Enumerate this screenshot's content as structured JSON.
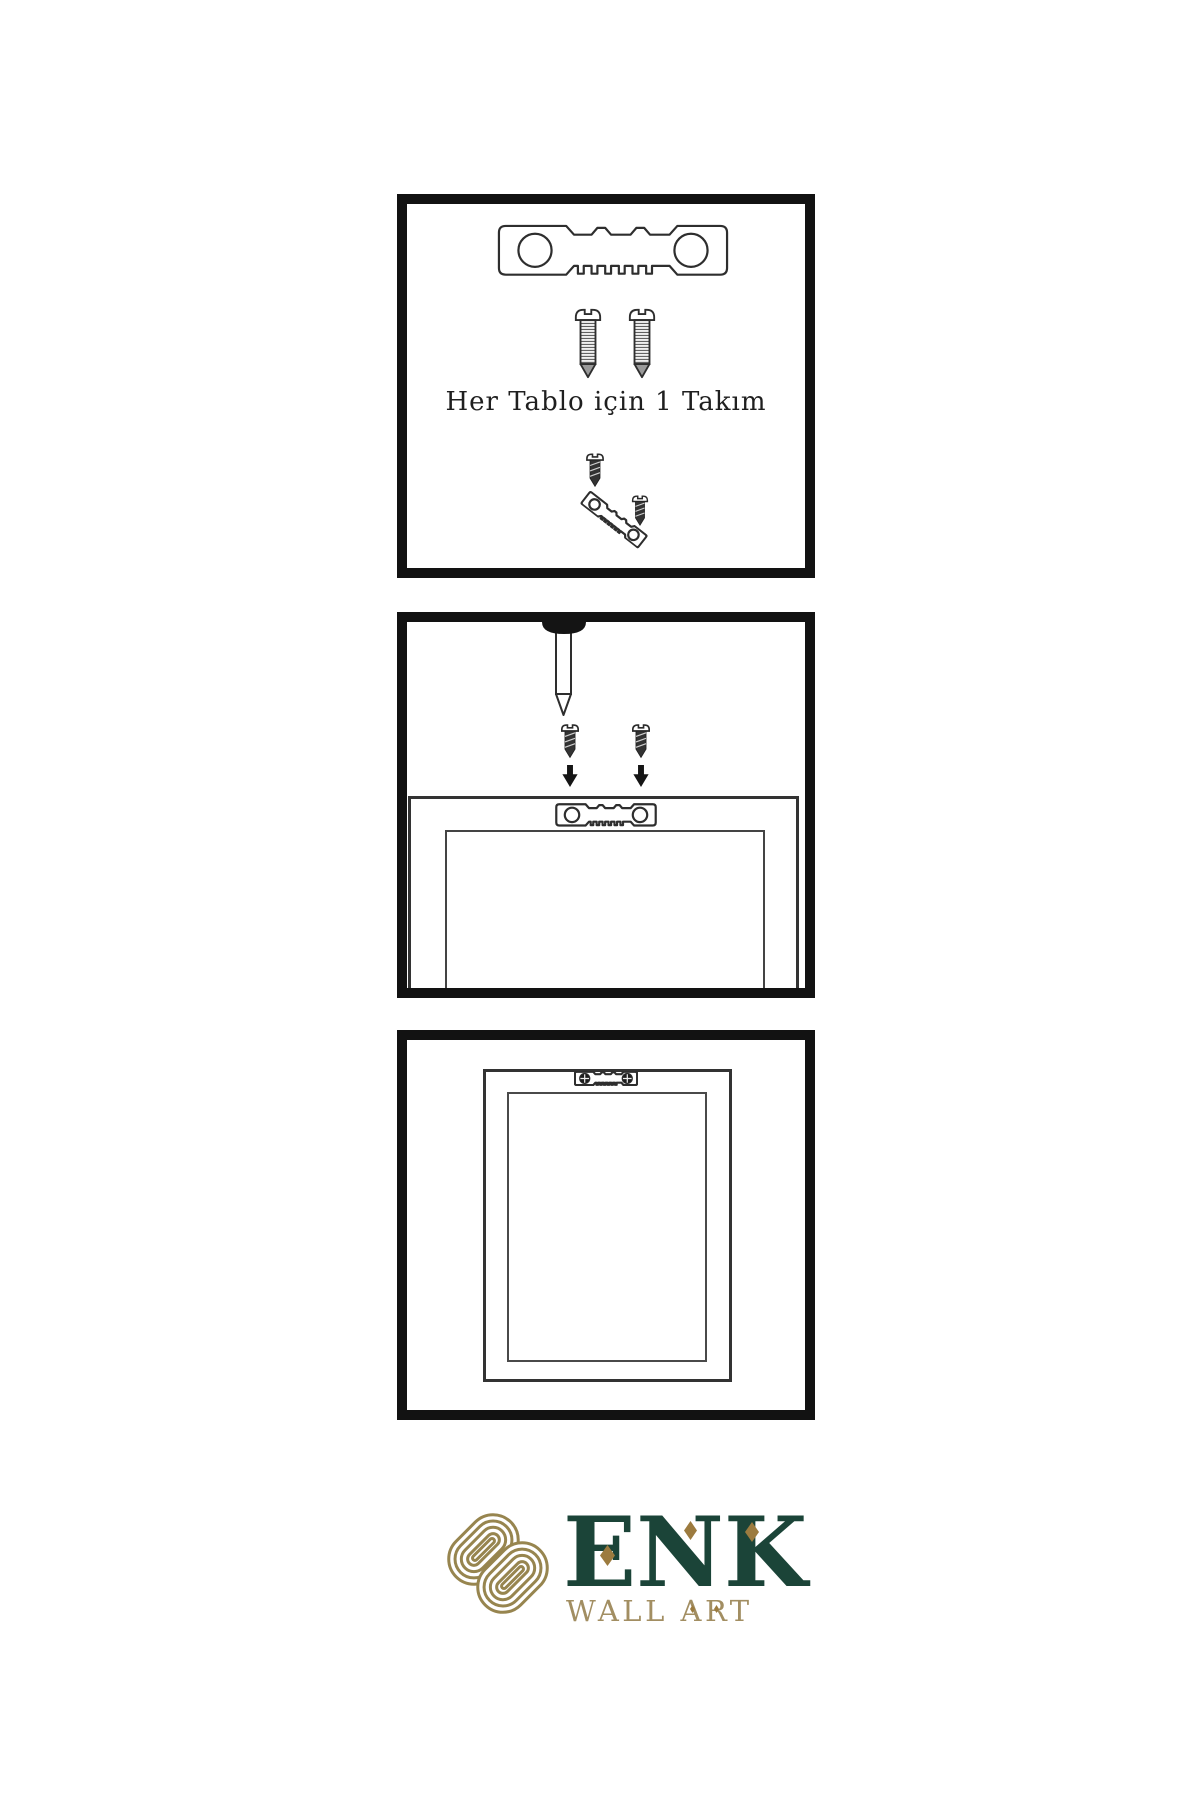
{
  "step1": {
    "caption": "Her Tablo için 1 Takım"
  },
  "logo": {
    "brand": "ENK",
    "tagline": "WALL ART"
  },
  "colors": {
    "background": "#ffffff",
    "panel_border": "#121212",
    "line_art": "#2e2e2e",
    "brand_green": "#1b4438",
    "brand_gold": "#97854f",
    "accent_gold": "#9c7b3f",
    "tagline_gold": "#a28e62"
  },
  "icons": {
    "sawtooth_hanger": "sawtooth-hanger-icon",
    "screw": "screw-icon",
    "small_screw": "dark-screw-icon",
    "nail": "nail-icon",
    "arrow_down": "arrow-down-icon",
    "frame_back": "picture-frame-back-icon",
    "frame_front": "picture-frame-front-icon",
    "knot": "knot-logo-icon",
    "crosshead_screw": "crosshead-screw-icon"
  }
}
